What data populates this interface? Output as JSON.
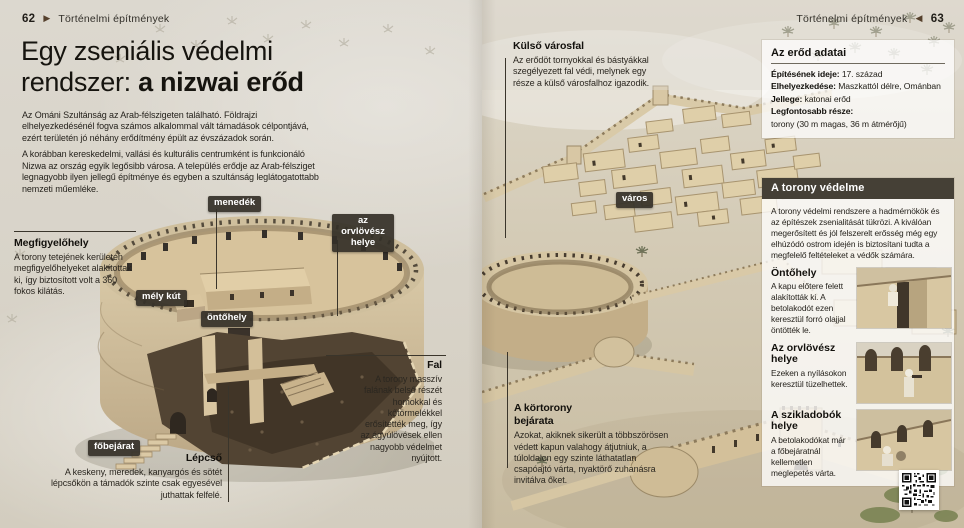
{
  "colors": {
    "badge_bg": "#343028",
    "panel_header_bg": "#454036",
    "paper": "#d8d3c8",
    "sand": "#cdbfa3",
    "wall_light": "#d8c8a6"
  },
  "header_left": {
    "folio": "62",
    "arrow": "▶",
    "section": "Történelmi építmények"
  },
  "header_right": {
    "folio": "63",
    "arrow": "◀",
    "section": "Történelmi építmények"
  },
  "title": {
    "line1": "Egy zseniális védelmi",
    "line2_regular": "rendszer: ",
    "line2_bold": "a nizwai erőd"
  },
  "intro": {
    "p1": "Az Ománi Szultánság az Arab-félszigeten található. Földrajzi elhelyezkedésénél fogva számos alkalommal vált támadások célpontjává, ezért területén jó néhány erődítmény épült az évszázadok során.",
    "p2": "A korábban kereskedelmi, vallási és kulturális centrumként is funkcionáló Nizwa az ország egyik legősibb városa. A település erődje az Arab-félsziget legnagyobb ilyen jellegű építménye és egyben a szultánság leglátogatottabb nemzeti műemléke."
  },
  "badges": {
    "menedek": "menedék",
    "orvlovesz": "az orvlövész helye",
    "mely_kut": "mély kút",
    "ontohely": "öntőhely",
    "fobejarat": "főbejárat",
    "varos": "város"
  },
  "annotations": {
    "megfigyelohely": {
      "title": "Megfigyelőhely",
      "body": "A torony tetejének kerületén megfigyelőhelyeket alakítottak ki, így biztosított volt a 360 fokos kilátás."
    },
    "lepcso": {
      "title": "Lépcső",
      "body": "A keskeny, meredek, kanyargós és sötét lépcsőkön a támadók szinte csak egyesével juthattak felfelé."
    },
    "fal": {
      "title": "Fal",
      "body": "A torony masszív falának belső részét homokkal és kőtörmelékkel erősítették meg, így az ágyúlövések ellen nagyobb védelmet nyújtott."
    },
    "kulso_varosfal": {
      "title": "Külső városfal",
      "body": "Az erődöt tornyokkal és bástyákkal szegélyezett fal védi, melynek egy része a külső városfalhoz igazodik."
    },
    "kortorony": {
      "title": "A körtorony bejárata",
      "body": "Azokat, akiknek sikerült a többszörösen védett kapun valahogy átjutniuk, a túloldalon egy szinte láthatatlan csapóajtó várta, nyaktörő zuhanásra invitálva őket."
    }
  },
  "fact_box": {
    "title": "Az erőd adatai",
    "rows": [
      {
        "label": "Építésének ideje:",
        "value": "17. század"
      },
      {
        "label": "Elhelyezkedése:",
        "value": "Maszkattól délre, Ománban"
      },
      {
        "label": "Jellege:",
        "value": "katonai erőd"
      },
      {
        "label": "Legfontosabb része:",
        "value": "torony (30 m magas, 36 m átmérőjű)"
      }
    ]
  },
  "defense_panel": {
    "header": "A torony védelme",
    "intro": "A torony védelmi rendszere a hadmérnökök és az építészek zsenialitását tükrözi. A kiválóan megerősített és jól felszerelt erősség még egy elhúzódó ostrom idején is biztosítani tudta a megfelelő feltételeket a védők számára.",
    "sections": [
      {
        "title": "Öntőhely",
        "body": "A kapu előtere felett alakították ki. A betolakodót ezen keresztül forró olajjal öntötték le."
      },
      {
        "title": "Az orvlövész helye",
        "body": "Ezeken a nyílásokon keresztül tüzelhettek."
      },
      {
        "title": "A szikladobók helye",
        "body": "A betolakodókat már a főbejáratnál kellemetlen meglepetés várta."
      }
    ]
  }
}
